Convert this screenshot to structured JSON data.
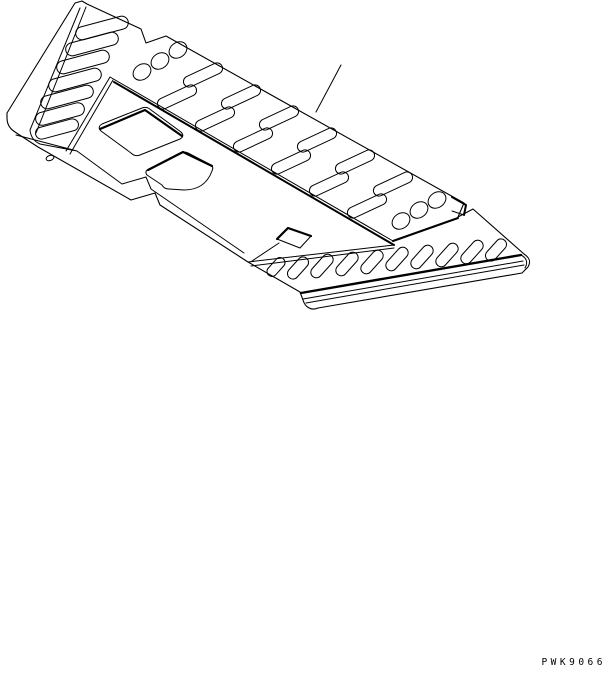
{
  "page": {
    "background": "#ffffff",
    "watermark": "PWK9066"
  },
  "figure": {
    "stroke": "#000000",
    "width": 613,
    "height": 673,
    "paths": [
      {
        "name": "plate-outer-outline",
        "w": 1.1,
        "d": "M 75 3 L 82 1 L 87 4 L 141 29 L 146 43 L 166 36 L 464 203 L 458 217 L 473 209 L 524 254 C 530 258 531 262 528 267 L 522 273 L 318 308 C 311 311 305 307 303 300 L 300 292 L 248 262 L 160 205 L 155 193 L 131 200 L 38 147 L 15 132 Q 7 127 7 118 L 7 113 Z"
      },
      {
        "name": "flange-inner-edges",
        "w": 1,
        "d": "M 80 8 L 30 130 M 86 7 L 36 133 M 30 130 Q 31 140 40 144 L 77 151 M 16 135 L 77 151 L 122 184 L 146 177 L 151 189 L 244 253"
      },
      {
        "name": "panel-apex-edge",
        "w": 1,
        "d": "M 110 77 L 66 151 M 113 80 L 70 154"
      },
      {
        "name": "fold-line-upper",
        "w": 1,
        "d": "M 110 77 L 393 241"
      },
      {
        "name": "fold-line-lower",
        "w": 2,
        "d": "M 114 82 L 394 245"
      },
      {
        "name": "rear-band-bottom-edge",
        "w": 2,
        "d": "M 393 241 L 458 218"
      },
      {
        "name": "tread-top-boundary",
        "w": 1,
        "d": "M 248 262 L 394 245 M 251 266 L 394 248"
      },
      {
        "name": "tread-front-edge-thick",
        "w": 2.4,
        "d": "M 301 293 L 521 255"
      },
      {
        "name": "tread-front-face-lines",
        "w": 1,
        "d": "M 303 299 L 523 261 M 306 303 L 524 265 M 521 255 C 527 258 528 263 525 268"
      },
      {
        "name": "quad-opening-1",
        "w": 1,
        "d": "M 102 124 L 142 108 Q 147 106 151 110 L 181 132 Q 185 136 180 139 L 140 155 Q 135 157 131 153 L 101 131 Q 97 127 102 124 Z"
      },
      {
        "name": "quad-opening-1-thick-edge",
        "w": 2.2,
        "d": "M 100 129 L 145 110 L 182 136"
      },
      {
        "name": "quad-opening-2",
        "w": 1,
        "d": "M 149 169 L 180 153 Q 184 151 188 153 L 211 165 Q 214 167 212 171 Q 205 190 184 190 L 169 189 Q 164 189 162 185 L 147 175 Q 144 171 149 169 Z"
      },
      {
        "name": "quad-opening-2-thick-edge",
        "w": 2.2,
        "d": "M 148 170 L 183 152 L 212 166"
      },
      {
        "name": "latch-tab",
        "w": 1,
        "d": "M 277 239 L 288 228 L 311 236 L 300 248 Z M 279 243 L 252 261"
      },
      {
        "name": "latch-tab-thick-edge",
        "w": 2.2,
        "d": "M 277 239 L 288 228 L 311 236"
      },
      {
        "name": "corner-notch-tab",
        "w": 2,
        "d": "M 452 197 L 466 205 L 464 215"
      },
      {
        "name": "corner-notch-tab-side",
        "w": 1,
        "d": "M 464 215 L 452 211"
      },
      {
        "name": "leader-line",
        "w": 1,
        "d": "M 341 65 L 316 112"
      }
    ],
    "slot_groups": [
      {
        "name": "left-band-slot",
        "slots": [
          [
            102,
            28,
            54,
            13,
            -15
          ],
          [
            92,
            44,
            54,
            13,
            -15
          ],
          [
            83,
            62,
            54,
            13,
            -15
          ],
          [
            75,
            80,
            54,
            13,
            -15
          ],
          [
            67,
            97,
            54,
            13,
            -15
          ],
          [
            60,
            114,
            50,
            13,
            -15
          ],
          [
            57,
            129,
            44,
            12,
            -15
          ]
        ]
      },
      {
        "name": "rear-band-slot",
        "slots": [
          [
            203,
            75,
            42,
            11,
            -25
          ],
          [
            177,
            97,
            42,
            11,
            -25
          ],
          [
            241,
            97,
            42,
            11,
            -25
          ],
          [
            215,
            119,
            42,
            11,
            -25
          ],
          [
            279,
            118,
            42,
            11,
            -25
          ],
          [
            253,
            140,
            42,
            11,
            -25
          ],
          [
            317,
            140,
            42,
            11,
            -25
          ],
          [
            291,
            162,
            42,
            11,
            -25
          ],
          [
            355,
            162,
            42,
            11,
            -25
          ],
          [
            329,
            184,
            42,
            11,
            -25
          ],
          [
            393,
            184,
            42,
            11,
            -25
          ],
          [
            367,
            206,
            42,
            11,
            -25
          ]
        ]
      },
      {
        "name": "tread-slot",
        "slots": [
          [
            276,
            267,
            22,
            10,
            -48
          ],
          [
            298,
            268,
            26,
            11,
            -48
          ],
          [
            322,
            266,
            28,
            11,
            -48
          ],
          [
            347,
            264,
            28,
            11,
            -48
          ],
          [
            372,
            262,
            28,
            11,
            -48
          ],
          [
            397,
            259,
            28,
            11,
            -48
          ],
          [
            422,
            257,
            28,
            11,
            -48
          ],
          [
            447,
            255,
            28,
            11,
            -48
          ],
          [
            472,
            252,
            28,
            11,
            -48
          ],
          [
            496,
            250,
            26,
            11,
            -48
          ]
        ]
      }
    ],
    "holes": [
      [
        142,
        72,
        9.5,
        7.5,
        -35
      ],
      [
        160,
        61,
        9.5,
        7.5,
        -35
      ],
      [
        178,
        50,
        9.5,
        7.5,
        -35
      ],
      [
        401,
        221,
        9.5,
        7.5,
        -35
      ],
      [
        419,
        210,
        9.5,
        7.5,
        -35
      ],
      [
        437,
        200,
        9.5,
        7.5,
        -35
      ],
      [
        50,
        158,
        4,
        2.5,
        -20
      ]
    ]
  }
}
